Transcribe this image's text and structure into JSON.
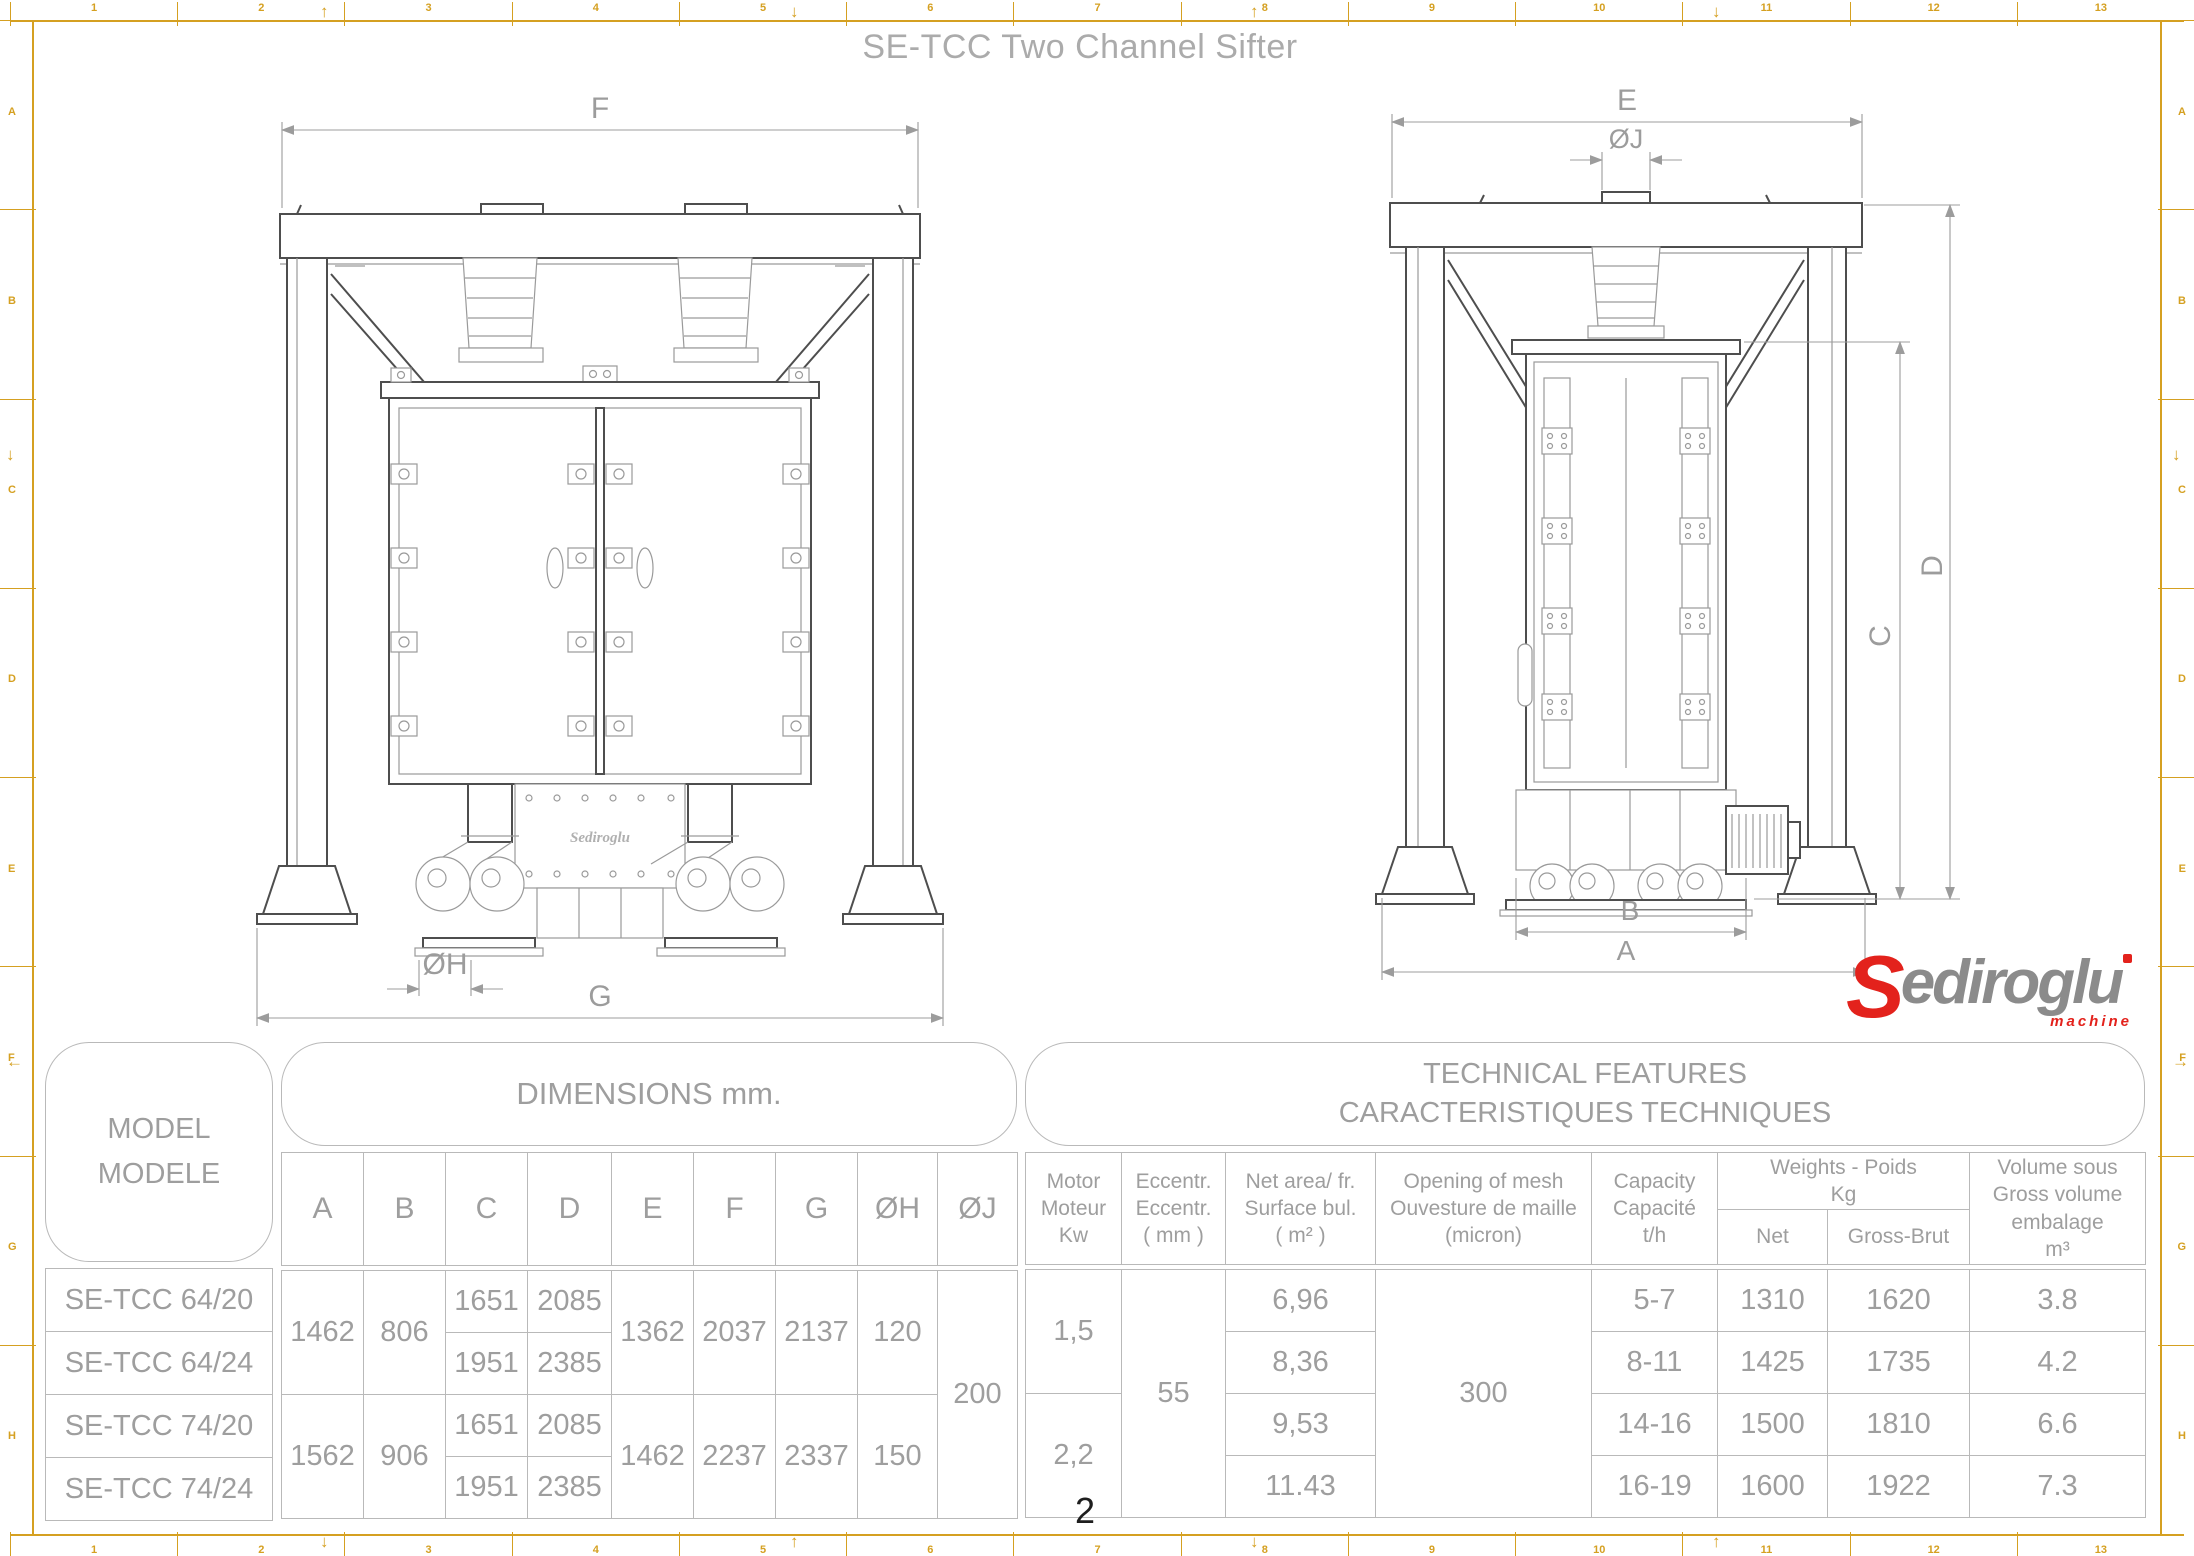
{
  "page": {
    "title": "SE-TCC Two Channel Sifter",
    "number": "2"
  },
  "colors": {
    "frame_gold": "#D5A021",
    "table_line": "#b9b9b9",
    "text_gray": "#9e9e9e",
    "title_gray": "#ababab",
    "drawing_dark": "#4e4e4e",
    "drawing_light": "#9a9a9a",
    "logo_red": "#e3221c",
    "logo_gray": "#8b8b8b"
  },
  "frame": {
    "top_numbers": [
      "1",
      "2",
      "3",
      "4",
      "5",
      "6",
      "7",
      "8",
      "9",
      "10",
      "11",
      "12",
      "13"
    ],
    "bottom_numbers": [
      "1",
      "2",
      "3",
      "4",
      "5",
      "6",
      "7",
      "8",
      "9",
      "10",
      "11",
      "12",
      "13"
    ],
    "left_letters": [
      "A",
      "B",
      "C",
      "D",
      "E",
      "F",
      "G",
      "H"
    ],
    "right_letters": [
      "A",
      "B",
      "C",
      "D",
      "E",
      "F",
      "G",
      "H"
    ],
    "marks": [
      {
        "side": "top",
        "x": 320,
        "dir": "up"
      },
      {
        "side": "top",
        "x": 790,
        "dir": "down"
      },
      {
        "side": "top",
        "x": 1250,
        "dir": "up"
      },
      {
        "side": "top",
        "x": 1712,
        "dir": "down"
      },
      {
        "side": "bottom",
        "x": 320,
        "dir": "down"
      },
      {
        "side": "bottom",
        "x": 790,
        "dir": "up"
      },
      {
        "side": "bottom",
        "x": 1250,
        "dir": "down"
      },
      {
        "side": "bottom",
        "x": 1712,
        "dir": "up"
      },
      {
        "side": "left",
        "y": 445,
        "dir": "down"
      },
      {
        "side": "left",
        "y": 1052,
        "dir": "left"
      },
      {
        "side": "right",
        "y": 445,
        "dir": "down"
      },
      {
        "side": "right",
        "y": 1052,
        "dir": "right"
      }
    ]
  },
  "logo": {
    "s": "S",
    "name": "ediroglu",
    "tagline": "machine"
  },
  "front_view": {
    "dim_f": "F",
    "dim_g": "G",
    "dim_oh": "ØH",
    "plate": "Sediroglu"
  },
  "side_view": {
    "dim_e": "E",
    "dim_oj": "ØJ",
    "dim_d": "D",
    "dim_c": "C",
    "dim_b": "B",
    "dim_a": "A"
  },
  "table": {
    "model_title": [
      "MODEL",
      "MODELE"
    ],
    "dims_title": "DIMENSIONS mm.",
    "tech_title": [
      "TECHNICAL FEATURES",
      "CARACTERISTIQUES TECHNIQUES"
    ],
    "dim_cols": [
      "A",
      "B",
      "C",
      "D",
      "E",
      "F",
      "G",
      "ØH",
      "ØJ"
    ],
    "tech_cols": {
      "motor": [
        "Motor",
        "Moteur",
        "Kw"
      ],
      "eccentr": [
        "Eccentr.",
        "Eccentr.",
        "( mm )"
      ],
      "net_area": [
        "Net area/ fr.",
        "Surface bul.",
        "( m² )"
      ],
      "mesh": [
        "Opening of mesh",
        "Ouvesture de maille",
        "(micron)"
      ],
      "capacity": [
        "Capacity",
        "Capacité",
        "t/h"
      ],
      "weights": [
        "Weights - Poids",
        "Kg"
      ],
      "net": "Net",
      "gross": "Gross-Brut",
      "volume": [
        "Volume sous",
        "Gross volume",
        "embalage",
        "m³"
      ]
    },
    "models": [
      "SE-TCC 64/20",
      "SE-TCC 64/24",
      "SE-TCC 74/20",
      "SE-TCC 74/24"
    ],
    "dims": {
      "A": [
        "1462",
        "1562"
      ],
      "B": [
        "806",
        "906"
      ],
      "C": [
        "1651",
        "1951",
        "1651",
        "1951"
      ],
      "D": [
        "2085",
        "2385",
        "2085",
        "2385"
      ],
      "E": [
        "1362",
        "1462"
      ],
      "F": [
        "2037",
        "2237"
      ],
      "G": [
        "2137",
        "2337"
      ],
      "OH": [
        "120",
        "150"
      ],
      "OJ": "200"
    },
    "tech": {
      "motor": [
        "1,5",
        "2,2"
      ],
      "eccentr": "55",
      "net_area": [
        "6,96",
        "8,36",
        "9,53",
        "11.43"
      ],
      "mesh": "300",
      "capacity": [
        "5-7",
        "8-11",
        "14-16",
        "16-19"
      ],
      "net": [
        "1310",
        "1425",
        "1500",
        "1600"
      ],
      "gross": [
        "1620",
        "1735",
        "1810",
        "1922"
      ],
      "volume": [
        "3.8",
        "4.2",
        "6.6",
        "7.3"
      ]
    }
  }
}
